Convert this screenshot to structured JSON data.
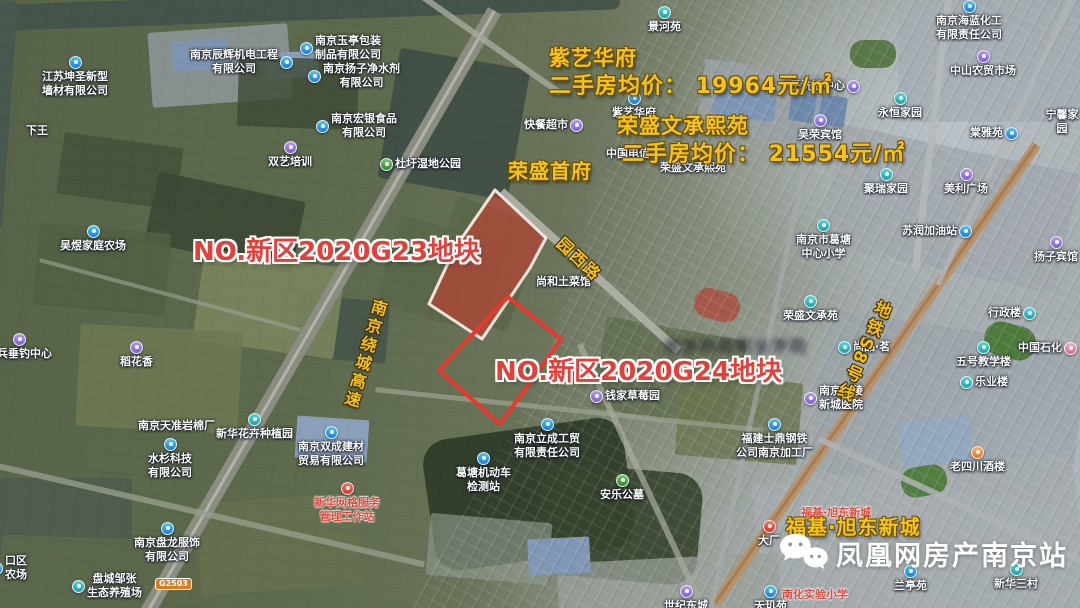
{
  "listings": [
    {
      "text": "紫艺华府",
      "x": 549,
      "y": 42,
      "size": 21
    },
    {
      "text": "二手房均价： 19964元/㎡",
      "x": 549,
      "y": 68,
      "size": 22
    },
    {
      "text": "荣盛文承熙苑",
      "x": 617,
      "y": 110,
      "size": 21
    },
    {
      "text": "二手房均价： 21554元/㎡",
      "x": 622,
      "y": 136,
      "size": 22
    },
    {
      "text": "荣盛首府",
      "x": 508,
      "y": 155,
      "size": 20
    },
    {
      "text": "福基·旭东新城",
      "x": 786,
      "y": 511,
      "size": 20
    }
  ],
  "parcels": [
    {
      "label": "NO.新区2020G23地块",
      "label_x": 193,
      "label_y": 231,
      "size": 26,
      "points": "495,190 546,238 530,268 482,339 429,304 455,248",
      "filled": true
    },
    {
      "label": "NO.新区2020G24地块",
      "label_x": 495,
      "label_y": 351,
      "size": 26,
      "points": "508,297 561,339 500,424 439,370",
      "filled": false
    }
  ],
  "road_labels": [
    {
      "text": "南京绕城高速",
      "x": 352,
      "y": 297,
      "rotate": 16,
      "vertical": true,
      "size": 16
    },
    {
      "text": "园西路",
      "x": 553,
      "y": 246,
      "rotate": 43,
      "vertical": false,
      "size": 16
    },
    {
      "text": "地铁S8号线",
      "x": 850,
      "y": 296,
      "rotate": 24,
      "vertical": true,
      "size": 17
    }
  ],
  "road_badge": "G2503",
  "illegible_watermark_text": "南京科技职业学院",
  "brand": {
    "name": "凤凰网房产南京站",
    "icon": "wechat-icon"
  },
  "colors": {
    "annotation_yellow": "#f4c41d",
    "annotation_red": "#e2403a",
    "poi_red": "#e0483c",
    "parcel_fill": "rgba(214,58,50,0.55)",
    "parcel_stroke": "#e8392f",
    "parcel_filled_stroke": "#f0e3da"
  },
  "pois": [
    {
      "text": "景河苑",
      "x": 648,
      "y": 6,
      "icon": "teal",
      "ipos": "above"
    },
    {
      "text": "南京海蓝化工\n有限责任公司",
      "x": 936,
      "y": 0,
      "icon": "blue",
      "ipos": "above"
    },
    {
      "text": "中山农贸市场",
      "x": 950,
      "y": 50,
      "icon": "purple",
      "ipos": "above"
    },
    {
      "text": "永恒家园",
      "x": 878,
      "y": 92,
      "icon": "teal",
      "ipos": "above"
    },
    {
      "text": "棠雅苑",
      "x": 970,
      "y": 126,
      "icon": "blue",
      "ipos": "right"
    },
    {
      "text": "宁馨家园",
      "x": 1044,
      "y": 108,
      "icon": "",
      "ipos": "none"
    },
    {
      "text": "吴荣宾馆",
      "x": 798,
      "y": 114,
      "icon": "purple",
      "ipos": "above"
    },
    {
      "text": "子洗浴中心",
      "x": 790,
      "y": 79,
      "icon": "purple",
      "ipos": "right"
    },
    {
      "text": "紫艺华府",
      "x": 612,
      "y": 92,
      "icon": "blue",
      "ipos": "above"
    },
    {
      "text": "快餐超市",
      "x": 524,
      "y": 118,
      "icon": "purple",
      "ipos": "right"
    },
    {
      "text": "中国电信",
      "x": 606,
      "y": 147,
      "icon": "",
      "ipos": "none"
    },
    {
      "text": "荣盛文承熙苑",
      "x": 660,
      "y": 161,
      "icon": "",
      "ipos": "none"
    },
    {
      "text": "杜圩湿地公园",
      "x": 380,
      "y": 157,
      "icon": "green",
      "ipos": "left"
    },
    {
      "text": "聚瑞家园",
      "x": 864,
      "y": 168,
      "icon": "teal",
      "ipos": "above"
    },
    {
      "text": "美利广场",
      "x": 944,
      "y": 168,
      "icon": "purple",
      "ipos": "above"
    },
    {
      "text": "南京市葛塘\n中心小学",
      "x": 796,
      "y": 219,
      "icon": "teal",
      "ipos": "above"
    },
    {
      "text": "苏润加油站",
      "x": 902,
      "y": 224,
      "icon": "blue",
      "ipos": "right"
    },
    {
      "text": "扬子宾馆",
      "x": 1034,
      "y": 236,
      "icon": "purple",
      "ipos": "above"
    },
    {
      "text": "吴煜家庭农场",
      "x": 60,
      "y": 225,
      "icon": "blue",
      "ipos": "above"
    },
    {
      "text": "尚和土菜馆",
      "x": 536,
      "y": 275,
      "icon": "",
      "ipos": "none"
    },
    {
      "text": "荣盛文承苑",
      "x": 783,
      "y": 295,
      "icon": "teal",
      "ipos": "above"
    },
    {
      "text": "行政楼",
      "x": 988,
      "y": 306,
      "icon": "teal",
      "ipos": "right"
    },
    {
      "text": "尚品·茗",
      "x": 838,
      "y": 340,
      "icon": "teal",
      "ipos": "left"
    },
    {
      "text": "五号教学楼",
      "x": 956,
      "y": 341,
      "icon": "teal",
      "ipos": "above"
    },
    {
      "text": "乐业楼",
      "x": 960,
      "y": 375,
      "icon": "teal",
      "ipos": "left"
    },
    {
      "text": "中国石化",
      "x": 1018,
      "y": 341,
      "icon": "pink",
      "ipos": "right"
    },
    {
      "text": "老兵垂钓中心",
      "x": -14,
      "y": 333,
      "icon": "purple",
      "ipos": "above"
    },
    {
      "text": "稻花香",
      "x": 120,
      "y": 341,
      "icon": "purple",
      "ipos": "above"
    },
    {
      "text": "下王",
      "x": 26,
      "y": 124,
      "icon": "",
      "ipos": "none"
    },
    {
      "text": "双艺培训",
      "x": 268,
      "y": 141,
      "icon": "purple",
      "ipos": "above"
    },
    {
      "text": "南京玉亭包装\n制品有限公司",
      "x": 300,
      "y": 34,
      "icon": "blue",
      "ipos": "left"
    },
    {
      "text": "南京扬子净水剂\n有限公司",
      "x": 308,
      "y": 62,
      "icon": "blue",
      "ipos": "left"
    },
    {
      "text": "南京宏银食品\n有限公司",
      "x": 316,
      "y": 112,
      "icon": "blue",
      "ipos": "left"
    },
    {
      "text": "南京辰辉机电工程\n有限公司",
      "x": 190,
      "y": 48,
      "icon": "blue",
      "ipos": "right"
    },
    {
      "text": "江苏坤圣新型\n墙材有限公司",
      "x": 42,
      "y": 56,
      "icon": "blue",
      "ipos": "above"
    },
    {
      "text": "南京金陵\n新城医院",
      "x": 804,
      "y": 384,
      "icon": "purple",
      "ipos": "left"
    },
    {
      "text": "钱家草莓园",
      "x": 590,
      "y": 389,
      "icon": "purple",
      "ipos": "left"
    },
    {
      "text": "南京天准岩棉厂",
      "x": 138,
      "y": 419,
      "icon": "",
      "ipos": "none"
    },
    {
      "text": "新华花卉种植园",
      "x": 216,
      "y": 413,
      "icon": "teal",
      "ipos": "above"
    },
    {
      "text": "南京双成建材\n贸易有限公司",
      "x": 298,
      "y": 426,
      "icon": "blue",
      "ipos": "above"
    },
    {
      "text": "水杉科技\n有限公司",
      "x": 148,
      "y": 438,
      "icon": "blue",
      "ipos": "above"
    },
    {
      "text": "南京立成工贸\n有限责任公司",
      "x": 514,
      "y": 418,
      "icon": "blue",
      "ipos": "above"
    },
    {
      "text": "葛塘机动车\n检测站",
      "x": 456,
      "y": 452,
      "icon": "blue",
      "ipos": "above"
    },
    {
      "text": "福建士鼎钢铁\n公司南京加工厂",
      "x": 736,
      "y": 418,
      "icon": "blue",
      "ipos": "above"
    },
    {
      "text": "安乐公墓",
      "x": 600,
      "y": 474,
      "icon": "green",
      "ipos": "above"
    },
    {
      "text": "老四川酒楼",
      "x": 950,
      "y": 446,
      "icon": "orange",
      "ipos": "above"
    },
    {
      "text": "新华网格服务\n管理工作站",
      "x": 314,
      "y": 482,
      "icon": "red",
      "ipos": "above",
      "red": true
    },
    {
      "text": "南京盘龙服饰\n有限公司",
      "x": 134,
      "y": 522,
      "icon": "blue",
      "ipos": "above"
    },
    {
      "text": "盘城邹张\n生态养殖场",
      "x": 72,
      "y": 572,
      "icon": "teal",
      "ipos": "left"
    },
    {
      "text": "口区\n农场",
      "x": -10,
      "y": 554,
      "icon": "blue",
      "ipos": "left"
    },
    {
      "text": "大厂",
      "x": 758,
      "y": 520,
      "icon": "red",
      "ipos": "above"
    },
    {
      "text": "世纪东城",
      "x": 664,
      "y": 585,
      "icon": "purple",
      "ipos": "above"
    },
    {
      "text": "天玑苑",
      "x": 754,
      "y": 585,
      "icon": "blue",
      "ipos": "above"
    },
    {
      "text": "兰亭苑",
      "x": 894,
      "y": 565,
      "icon": "blue",
      "ipos": "above"
    },
    {
      "text": "新华三村",
      "x": 994,
      "y": 563,
      "icon": "teal",
      "ipos": "above"
    },
    {
      "text": "南化实验小学",
      "x": 782,
      "y": 588,
      "icon": "",
      "ipos": "none",
      "red": true
    },
    {
      "text": "福基·旭东新城",
      "x": 801,
      "y": 506,
      "icon": "",
      "ipos": "none",
      "red": true
    }
  ]
}
